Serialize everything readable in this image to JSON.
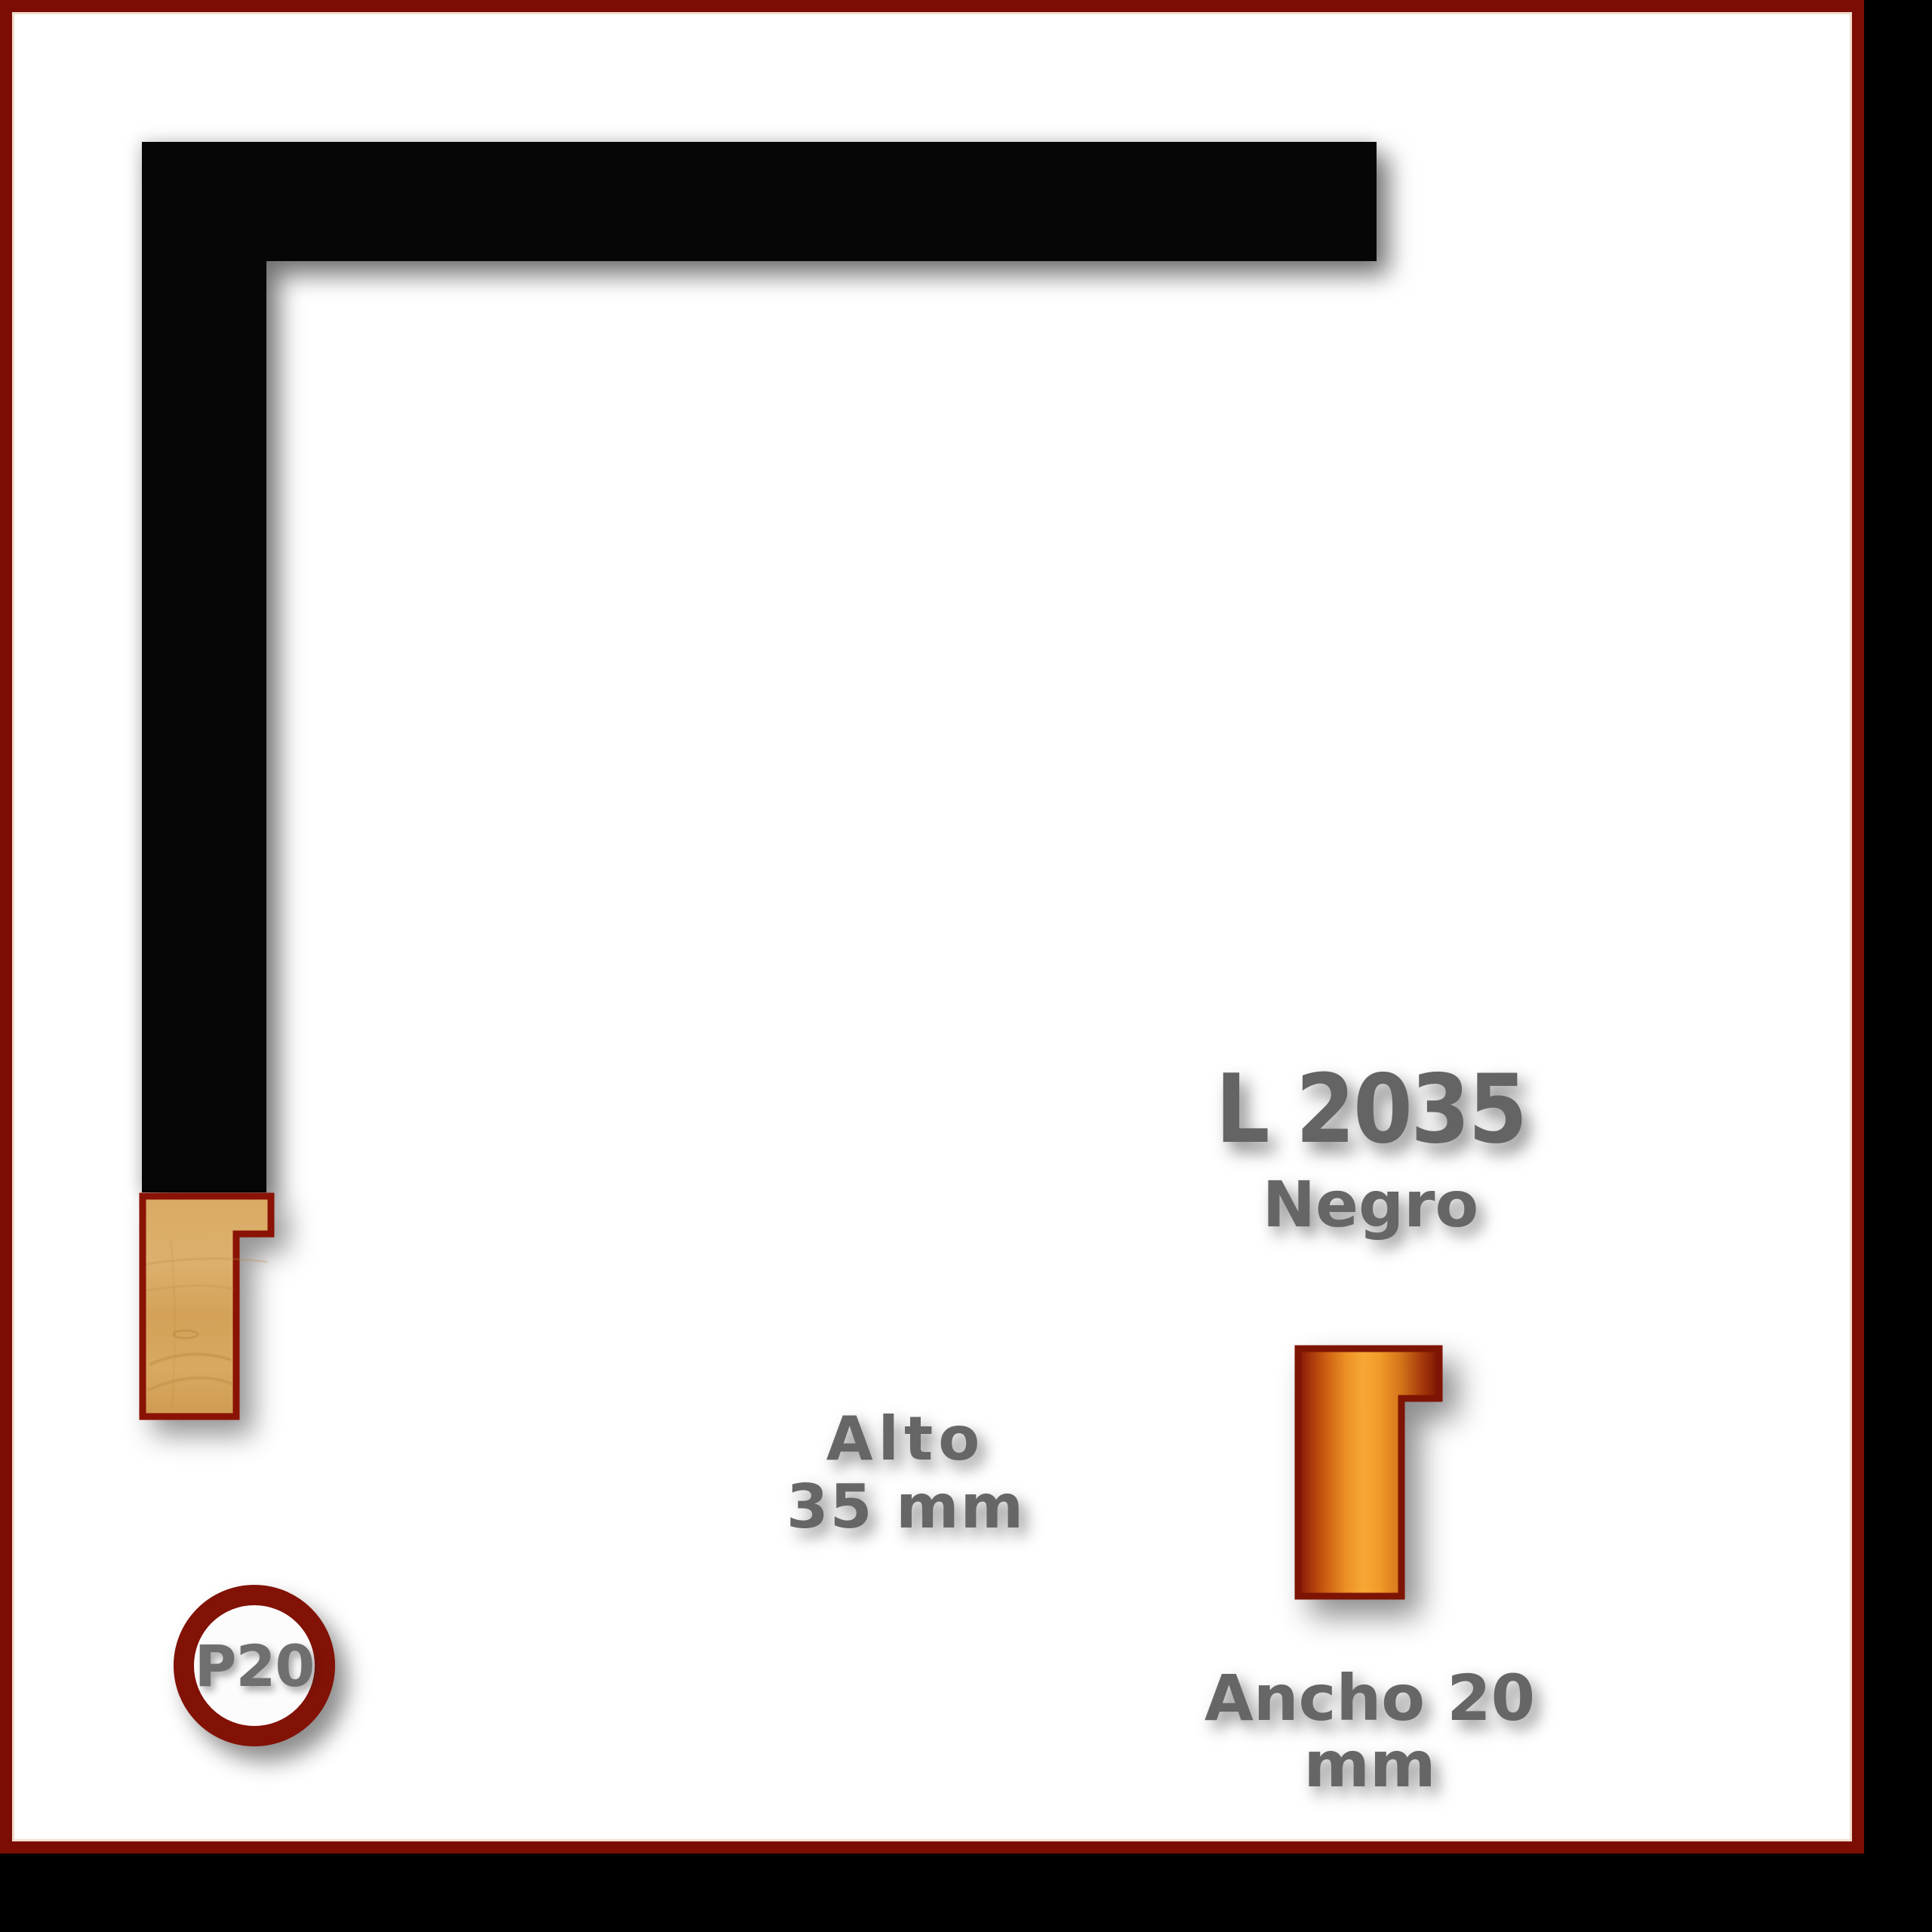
{
  "card": {
    "type": "picture-frame moulding catalog card",
    "border_color": "#7c0d04",
    "inner_line_color": "#eed7c4",
    "background": "#ffffff",
    "outside_background": "#000000"
  },
  "corner_sample": {
    "description": "black L-shaped frame corner sample",
    "color": "#060606"
  },
  "cross_section": {
    "description": "wood moulding profile cross-section with rabbet",
    "outline_color": "#8a1305",
    "wood_color": "#d5a55f"
  },
  "profile_icon": {
    "description": "orange moulding profile pictogram",
    "outline_color": "#7e1404",
    "gradient": [
      "#7b1404",
      "#f7a835",
      "#7b1404"
    ]
  },
  "labels": {
    "code": "L 2035",
    "finish": "Negro",
    "height_label": "Alto",
    "height_value": "35 mm",
    "width_label": "Ancho 20 mm",
    "badge": "P20"
  },
  "text_color": "#666666"
}
